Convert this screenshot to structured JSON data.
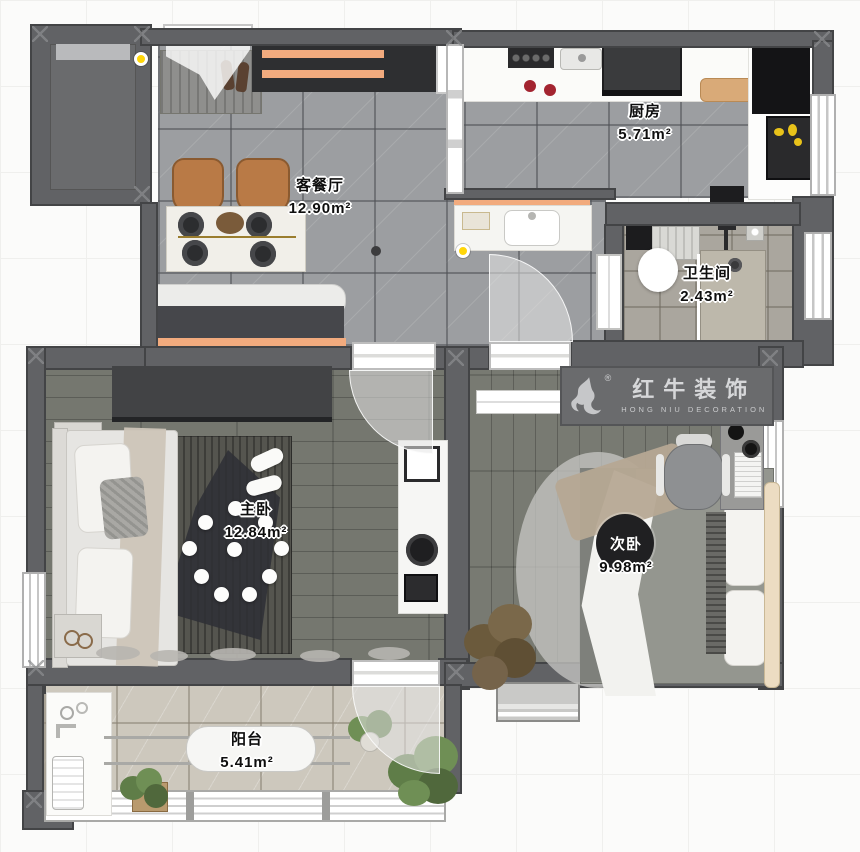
{
  "rooms": {
    "living": {
      "name": "客餐厅",
      "area": "12.90m²"
    },
    "kitchen": {
      "name": "厨房",
      "area": "5.71m²"
    },
    "bath": {
      "name": "卫生间",
      "area": "2.43m²"
    },
    "master": {
      "name": "主卧",
      "area": "12.84m²"
    },
    "second": {
      "name": "次卧",
      "area": "9.98m²"
    },
    "balcony": {
      "name": "阳台",
      "area": "5.41m²"
    }
  },
  "logo": {
    "brand": "红牛装饰",
    "subtitle": "HONG NIU DECORATION",
    "registered": "®"
  },
  "colors": {
    "wall": "#616265",
    "accent_orange": "#f2ab7e",
    "light_yellow": "#ffd60a",
    "logo_band": "#6a6b6d",
    "tile_gray": "#9c9ea1",
    "wood": "#75776f",
    "balcony_tile": "#cdc8bd",
    "bath_tile": "#aaa69e"
  }
}
